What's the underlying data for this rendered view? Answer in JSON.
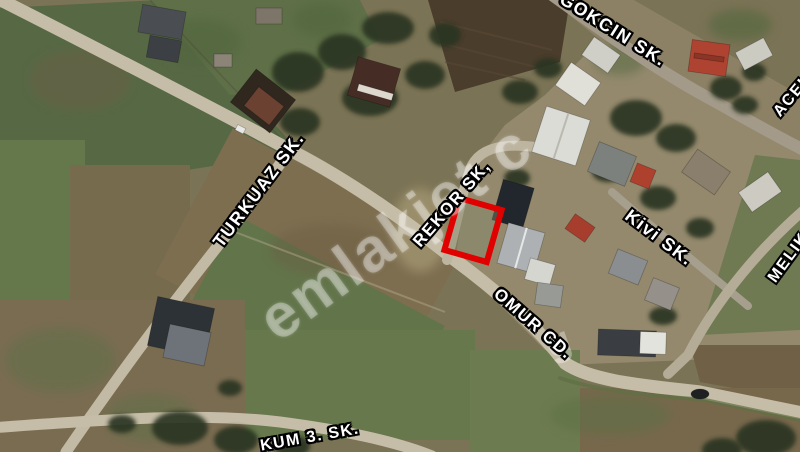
{
  "map": {
    "type_note": "satellite-aerial-view",
    "watermark_text": "emlakjet c",
    "watermark_fragment": "g",
    "labels": {
      "gokcin": "GOKCIN SK.",
      "turkuaz": "TURKUAZ SK.",
      "rekor": "REKOR SK,",
      "kivi": "Kivi SK.",
      "omur": "OMUR CD.",
      "melik": "MELIK",
      "acelya": "ACEL",
      "kum": "KUM 3. SK."
    },
    "parcel": {
      "outline_color": "#e10000"
    }
  }
}
